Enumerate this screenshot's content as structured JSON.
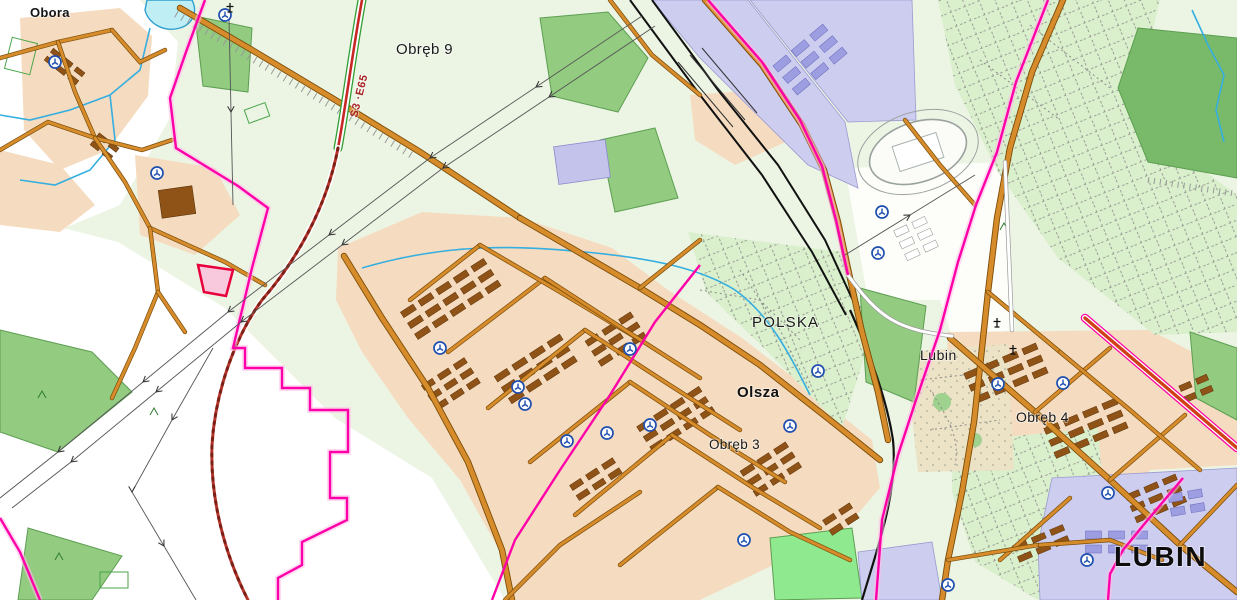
{
  "map": {
    "title": "Topographic map of Lubin area",
    "labels": [
      {
        "id": "obora",
        "text": "Obora",
        "x": 30,
        "y": 17,
        "size": 13,
        "weight": "600",
        "color": "#151515",
        "rotate": 0,
        "spacing": 0.3
      },
      {
        "id": "obreb-9",
        "text": "Obręb 9",
        "x": 396,
        "y": 54,
        "size": 15,
        "weight": "400",
        "color": "#1a1a1a",
        "rotate": 0,
        "spacing": 0.4
      },
      {
        "id": "s3-e65",
        "text": "S3 ·E65",
        "x": 357,
        "y": 118,
        "size": 11,
        "weight": "700",
        "color": "#a82424",
        "rotate": -76,
        "spacing": 0.6
      },
      {
        "id": "polska",
        "text": "POLSKA",
        "x": 752,
        "y": 327,
        "size": 15,
        "weight": "400",
        "color": "#1a1a1a",
        "rotate": 0,
        "spacing": 1.2
      },
      {
        "id": "lubin-district",
        "text": "Lubin",
        "x": 920,
        "y": 360,
        "size": 14,
        "weight": "400",
        "color": "#1a1a1a",
        "rotate": 0,
        "spacing": 0.5
      },
      {
        "id": "olsza",
        "text": "Olsza",
        "x": 737,
        "y": 397,
        "size": 15,
        "weight": "600",
        "color": "#111111",
        "rotate": 0,
        "spacing": 0.5
      },
      {
        "id": "obreb-3",
        "text": "Obręb 3",
        "x": 709,
        "y": 449,
        "size": 13.5,
        "weight": "400",
        "color": "#1a1a1a",
        "rotate": 0,
        "spacing": 0.3
      },
      {
        "id": "obreb-4",
        "text": "Obręb 4",
        "x": 1016,
        "y": 422,
        "size": 14,
        "weight": "400",
        "color": "#1a1a1a",
        "rotate": 0,
        "spacing": 0.3
      },
      {
        "id": "lubin-city",
        "text": "LUBIN",
        "x": 1114,
        "y": 566,
        "size": 28,
        "weight": "700",
        "color": "#0d0d0d",
        "rotate": 0,
        "spacing": 1.5
      }
    ],
    "poi": {
      "church_symbols": [
        [
          55,
          62
        ],
        [
          225,
          15
        ],
        [
          157,
          173
        ],
        [
          440,
          348
        ],
        [
          518,
          387
        ],
        [
          525,
          404
        ],
        [
          630,
          349
        ],
        [
          607,
          433
        ],
        [
          567,
          441
        ],
        [
          790,
          426
        ],
        [
          818,
          371
        ],
        [
          882,
          212
        ],
        [
          878,
          253
        ],
        [
          998,
          384
        ],
        [
          1063,
          383
        ],
        [
          948,
          585
        ],
        [
          1087,
          560
        ],
        [
          1108,
          493
        ],
        [
          744,
          540
        ],
        [
          650,
          425
        ]
      ],
      "cemetery_crosses": [
        [
          230,
          8
        ],
        [
          997,
          323
        ],
        [
          1013,
          350
        ]
      ]
    },
    "palette": {
      "bg": "#ecf5e4",
      "white": "#ffffff",
      "tan": "#f5dcc0",
      "building": "#8f5217",
      "building_edge": "#5e3408",
      "purple_bld": "#9d9de2",
      "lavender": "#cdcdf0",
      "road": "#d78c2c",
      "road_casing": "#7a4c08",
      "allot": "#daefcc",
      "forest": "#93cb80",
      "forest_dark": "#79b96a",
      "forest_edge": "#5d9e52",
      "field_bright": "#8fe98f",
      "park": "#ece2c6",
      "lake": "#bfeef4",
      "water": "#2e9fd0",
      "rail": "#111111",
      "boundary": "#ff00a8",
      "boundary_glow": "#ffc0ea",
      "s3_red": "#c62828",
      "s3_green": "#2f9e33",
      "red_road": "#d04018",
      "power": "#555555",
      "symbol_blue": "#1f4fae",
      "special_area_fill": "#f8c8dc",
      "special_area_edge": "#e8003c"
    }
  }
}
